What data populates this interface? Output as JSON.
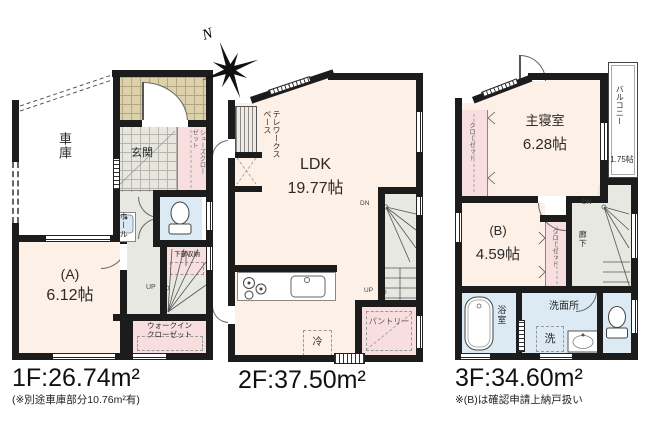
{
  "compass": {
    "label": "N"
  },
  "colors": {
    "wall": "#1c1c1c",
    "room": "#fdf0e6",
    "closet": "#f8dede",
    "wet_area": "#dcebf3",
    "hall_stairs": "#e7e8e2",
    "porch_tile": "#ddd1ab"
  },
  "icons": {
    "toilet": "toilet-icon",
    "bathtub": "bathtub-icon",
    "washbasin": "washbasin-icon",
    "stove": "stove-icon",
    "kitchen_sink": "kitchen-sink-icon",
    "compass": "compass-rose-icon"
  },
  "floor1": {
    "area_label": "1F:26.74m²",
    "area_note": "(※別途車庫部分10.76m²有)",
    "rooms": {
      "garage": "車庫",
      "entrance": "玄関",
      "shoes_closet": "シューズクローゼット",
      "hall": "ホール",
      "under_stairs_storage": "下部収納",
      "up": "UP",
      "walkin_closet_line1": "ウォークイン",
      "walkin_closet_line2": "クローゼット",
      "room_a": "(A)",
      "room_a_size": "6.12帖"
    }
  },
  "floor2": {
    "area_label": "2F:37.50m²",
    "rooms": {
      "telework": "テレワークスペース",
      "ldk": "LDK",
      "ldk_size": "19.77帖",
      "pantry": "パントリー",
      "fridge": "冷",
      "dn": "DN",
      "up": "UP"
    }
  },
  "floor3": {
    "area_label": "3F:34.60m²",
    "area_note": "※(B)は確認申請上納戸扱い",
    "rooms": {
      "master_bedroom": "主寝室",
      "master_bedroom_size": "6.28帖",
      "balcony": "バルコニー",
      "balcony_size": "1.75帖",
      "closet": "クローゼット",
      "room_b": "(B)",
      "room_b_size": "4.59帖",
      "corridor": "廊下",
      "dn": "DN",
      "bath": "浴室",
      "washroom": "洗面所",
      "laundry": "洗"
    }
  }
}
